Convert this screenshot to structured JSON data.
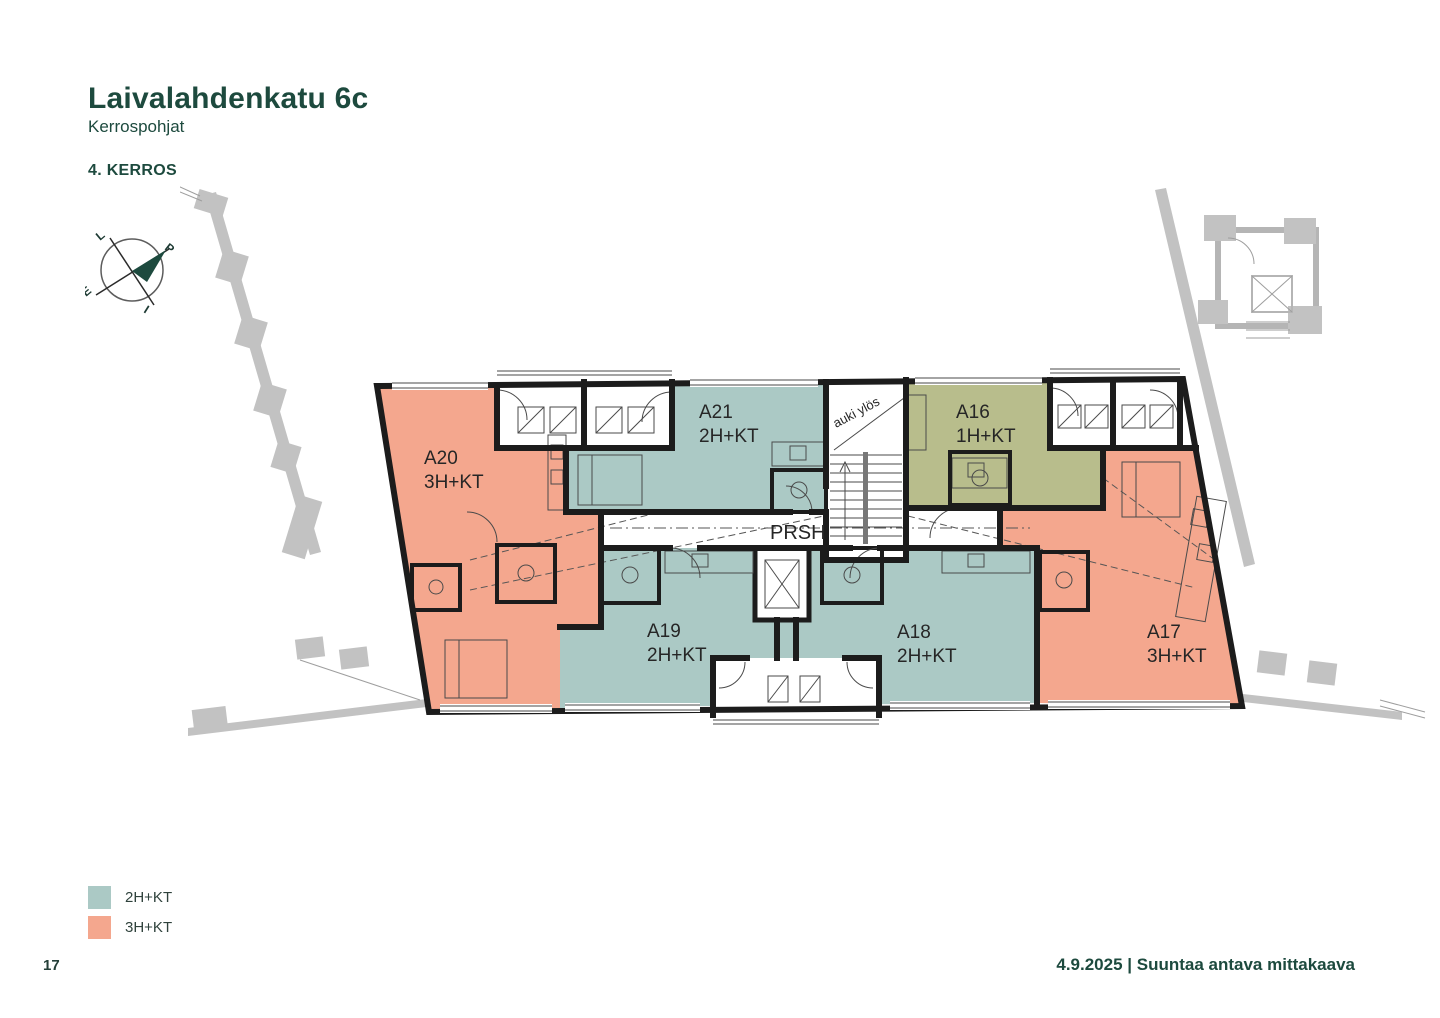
{
  "page": {
    "title": "Laivalahdenkatu 6c",
    "subtitle": "Kerrospohjat",
    "floor_label": "4. KERROS",
    "page_number": "17",
    "footer_right": "4.9.2025 | Suuntaa antava mittakaava"
  },
  "colors": {
    "accent_green": "#1d4a3e",
    "apartment_2hkt_teal": "#abc9c5",
    "apartment_3hkt_salmon": "#f4a78e",
    "apartment_1hkt_olive": "#b8bd8c",
    "neighbor_gray": "#c2c2c2",
    "wall_black": "#1c1c1c"
  },
  "compass": {
    "west": "L",
    "north": "P",
    "south": "E",
    "east": "I"
  },
  "legend": [
    {
      "label": "2H+KT",
      "color": "#abc9c5"
    },
    {
      "label": "3H+KT",
      "color": "#f4a78e"
    }
  ],
  "plan": {
    "corridor_label": "PRSH",
    "stair_label": "auki ylös",
    "apartments": [
      {
        "id": "A20",
        "type": "3H+KT"
      },
      {
        "id": "A21",
        "type": "2H+KT"
      },
      {
        "id": "A16",
        "type": "1H+KT"
      },
      {
        "id": "A19",
        "type": "2H+KT"
      },
      {
        "id": "A18",
        "type": "2H+KT"
      },
      {
        "id": "A17",
        "type": "3H+KT"
      }
    ]
  }
}
